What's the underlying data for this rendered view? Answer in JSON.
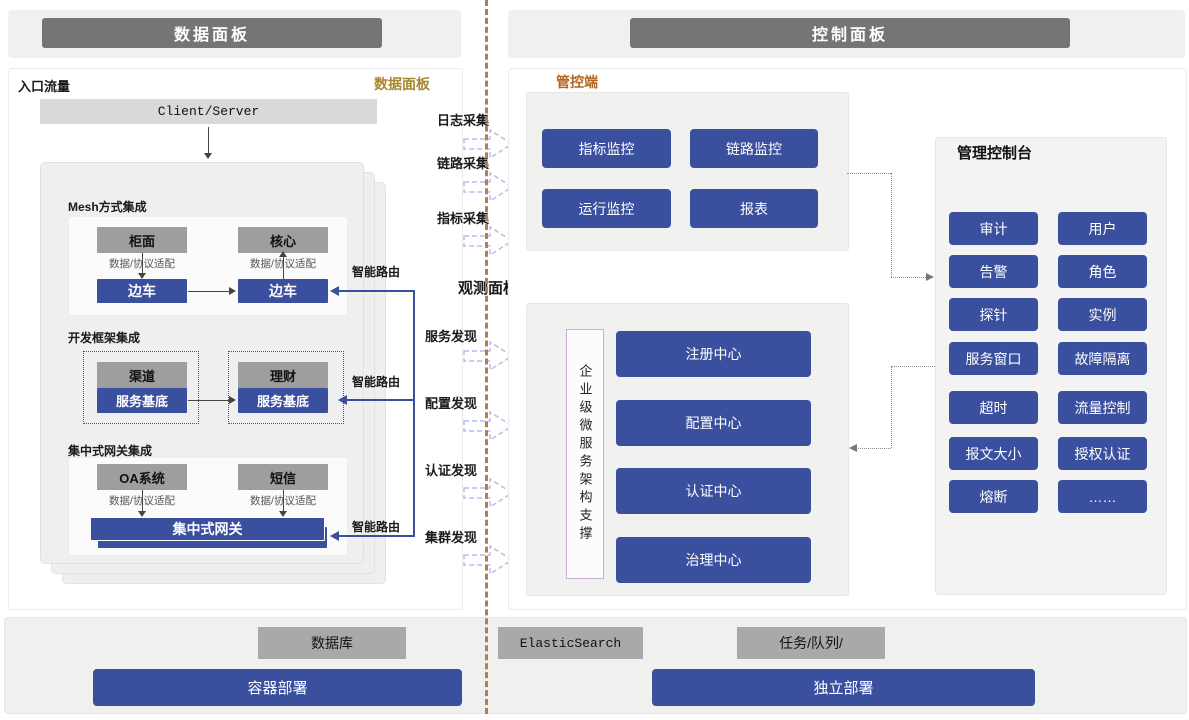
{
  "colors": {
    "accent_blue": "#3a4f9e",
    "header_gray": "#757575",
    "gold_label": "#a6882e",
    "orange_label": "#b2661f",
    "divider_brown": "#b27e54"
  },
  "headers": {
    "left": "数据面板",
    "right": "控制面板"
  },
  "data_plane": {
    "corner_title": "数据面板",
    "entry_label": "入口流量",
    "client_server": "Client/Server",
    "smart_route": "智能路由",
    "sections": [
      {
        "label": "Mesh方式集成",
        "top_boxes": [
          "柜面",
          "核心"
        ],
        "adapter": "数据/协议适配",
        "bottom_boxes": [
          "边车",
          "边车"
        ]
      },
      {
        "label": "开发框架集成",
        "top_boxes": [
          "渠道",
          "理财"
        ],
        "bottom_boxes": [
          "服务基底",
          "服务基底"
        ]
      },
      {
        "label": "集中式网关集成",
        "top_boxes": [
          "OA系统",
          "短信"
        ],
        "adapter": "数据/协议适配",
        "gateway": "集中式网关"
      }
    ]
  },
  "flows": {
    "collect": [
      "日志采集",
      "链路采集",
      "指标采集"
    ],
    "observe_label": "观测面板",
    "discover": [
      "服务发现",
      "配置发现",
      "认证发现",
      "集群发现"
    ]
  },
  "control_plane": {
    "mgmt_label": "管控端",
    "monitor_buttons": [
      "指标监控",
      "链路监控",
      "运行监控",
      "报表"
    ],
    "observe_support": "企业级微服务架构支撑",
    "center_bars": [
      "注册中心",
      "配置中心",
      "认证中心",
      "治理中心"
    ],
    "console": {
      "title": "管理控制台",
      "buttons": [
        "审计",
        "用户",
        "告警",
        "角色",
        "探针",
        "实例",
        "服务窗口",
        "故障隔离",
        "超时",
        "流量控制",
        "报文大小",
        "授权认证",
        "熔断",
        "……"
      ]
    }
  },
  "footer": {
    "gray_boxes": [
      "数据库",
      "ElasticSearch",
      "任务/队列/"
    ],
    "blue_bars": [
      "容器部署",
      "独立部署"
    ]
  }
}
